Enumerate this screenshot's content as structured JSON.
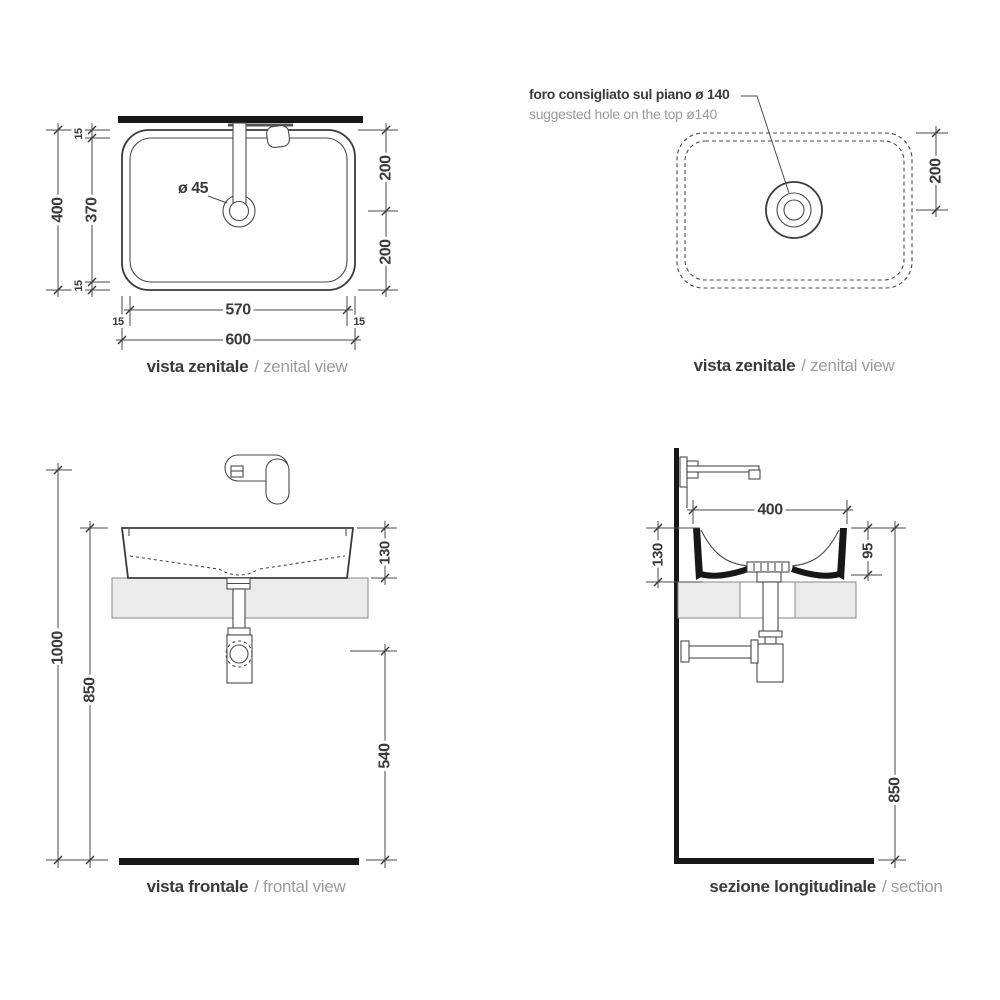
{
  "colors": {
    "ink": "#3a3a3a",
    "light_text": "#9b9b9b",
    "heavy_black": "#171717",
    "counter_fill": "#ebebeb"
  },
  "views": {
    "zenital_left": {
      "caption": {
        "it": "vista zenitale",
        "en": "/ zenital view"
      },
      "labels": {
        "drain_diameter": "ø 45"
      },
      "dims": {
        "overall_height": "400",
        "basin_height": "370",
        "offset_top": "15",
        "offset_bottom": "15",
        "drain_from_top": "200",
        "drain_from_bottom": "200",
        "basin_width": "570",
        "offset_left": "15",
        "offset_right": "15",
        "overall_width": "600"
      }
    },
    "zenital_right": {
      "caption": {
        "it": "vista zenitale",
        "en": "/ zenital view"
      },
      "note": {
        "it": "foro consigliato sul piano ø 140",
        "en": "suggested hole on the top ø140"
      },
      "dims": {
        "hole_from_top": "200"
      }
    },
    "frontal": {
      "caption": {
        "it": "vista frontale",
        "en": "/ frontal view"
      },
      "dims": {
        "total_height": "1000",
        "rim_height": "850",
        "basin_height": "130",
        "trap_height": "540"
      }
    },
    "section": {
      "caption": {
        "it": "sezione longitudinale",
        "en": "/ section"
      },
      "dims": {
        "basin_width": "400",
        "basin_height": "130",
        "inner_depth": "95",
        "rim_height": "850"
      }
    }
  }
}
